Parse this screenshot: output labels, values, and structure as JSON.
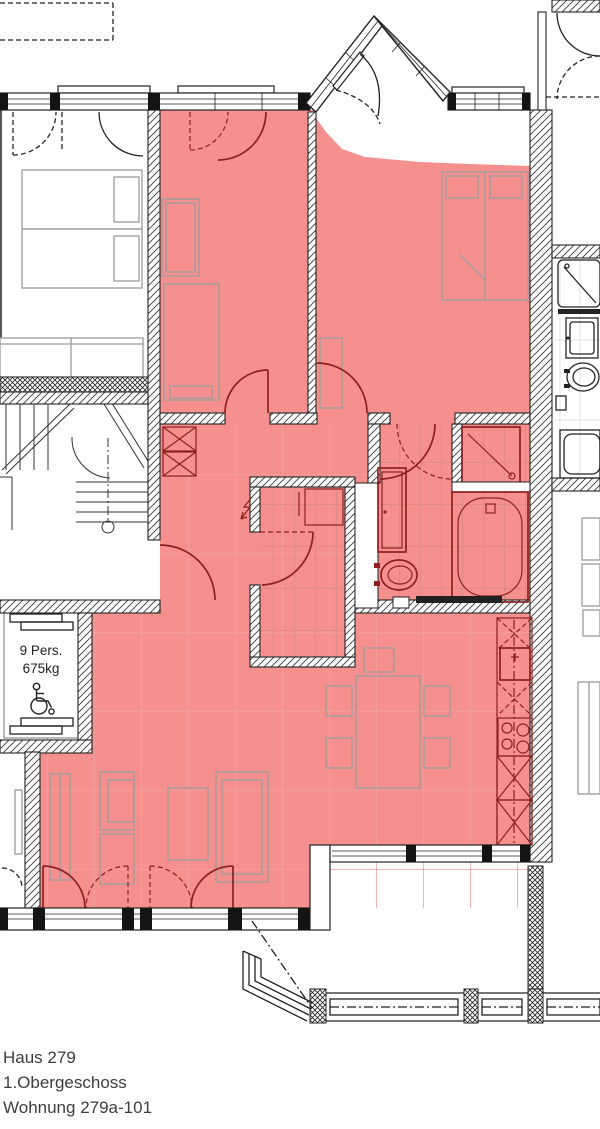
{
  "plan": {
    "type": "floor-plan",
    "title_block": {
      "house": "Haus 279",
      "floor": "1.Obergeschoss",
      "apartment": "Wohnung 279a-101"
    },
    "elevator_label": {
      "persons": "9 Pers.",
      "capacity": "675kg"
    },
    "colors": {
      "apartment_highlight": "#f5908e",
      "tile_line": "#dd8a88",
      "wall_line": "#222222",
      "door_accent": "#8e1f1f",
      "furniture_line": "#9c9c9c",
      "text": "#3d3d3d"
    }
  }
}
